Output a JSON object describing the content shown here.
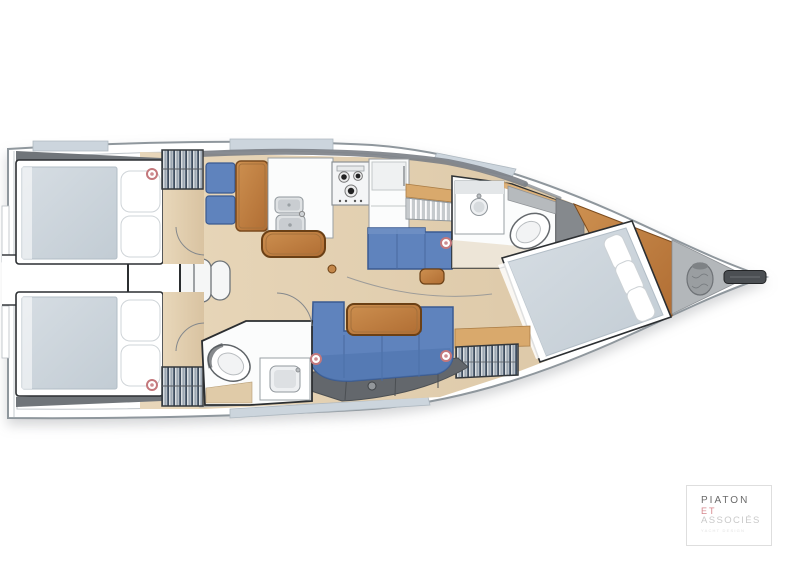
{
  "meta": {
    "canvas_width": 800,
    "canvas_height": 573
  },
  "logo": {
    "line1": "PIATON",
    "line2": "ET",
    "line3": "ASSOCIÉS",
    "tagline": "YACHT DESIGN",
    "color_line1": "#6a6a6a",
    "color_line2": "#d4878d",
    "color_line3": "#c9c9c9",
    "border_color": "#dedede"
  },
  "palette": {
    "hull-stroke": "#8f979d",
    "deck-line": "#c0c6cb",
    "floor": "#e2cfaf",
    "floor-dark": "#d9c3a1",
    "wood": "#c4874a",
    "wood-dark": "#6b4015",
    "wood-light": "#d9a96c",
    "sofa": "#5f83bd",
    "sofa-dark": "#3a5a91",
    "mattress": "#ccd5dc",
    "white-furniture": "#fbfcfc",
    "furniture-stroke": "#9aa0a4",
    "wall": "#2c2f32",
    "gray-panel": "#85898d",
    "gray-dark": "#63676c",
    "coaming": "#7b8086",
    "hatch": "#ccd5dd",
    "marker": "#c4787c",
    "steel": "#dfe2e4"
  },
  "plan": {
    "speaker_markers": [
      {
        "x": 152,
        "y": 174
      },
      {
        "x": 152,
        "y": 385
      },
      {
        "x": 446,
        "y": 243
      },
      {
        "x": 316,
        "y": 359
      },
      {
        "x": 446,
        "y": 356
      }
    ]
  }
}
